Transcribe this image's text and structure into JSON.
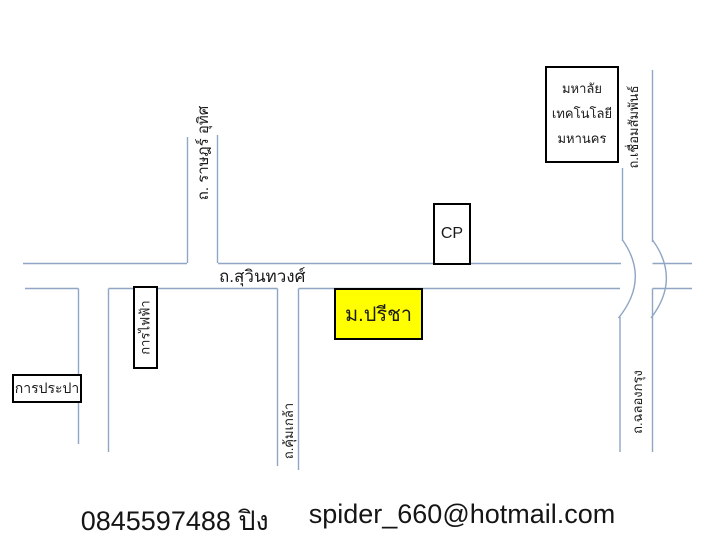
{
  "map": {
    "road_line_color": "#8fa6c4",
    "roads": {
      "suwinthawong": "ถ.สุวินทวงศ์",
      "rat_uthit": "ถ. ราษฎร์ อุทิศ",
      "chuem_samphan": "ถ.เชื่อมสัมพันธ์",
      "khum_klao": "ถ.คุ้มเกล้า",
      "chalong_krung": "ถ.ฉลองกรุง"
    },
    "boxes": {
      "university": {
        "lines": [
          "มหาลัย",
          "เทคโนโลยี",
          "มหานคร"
        ]
      },
      "cp": {
        "label": "CP"
      },
      "preecha": {
        "label": "ม.ปรีชา",
        "fill": "#FFFF00"
      },
      "waterworks": {
        "label": "การประปา"
      },
      "electricity": {
        "label": "การไฟฟ้า"
      }
    }
  },
  "footer": {
    "phone": "0845597488 ปิง",
    "email": "spider_660@hotmail.com"
  }
}
